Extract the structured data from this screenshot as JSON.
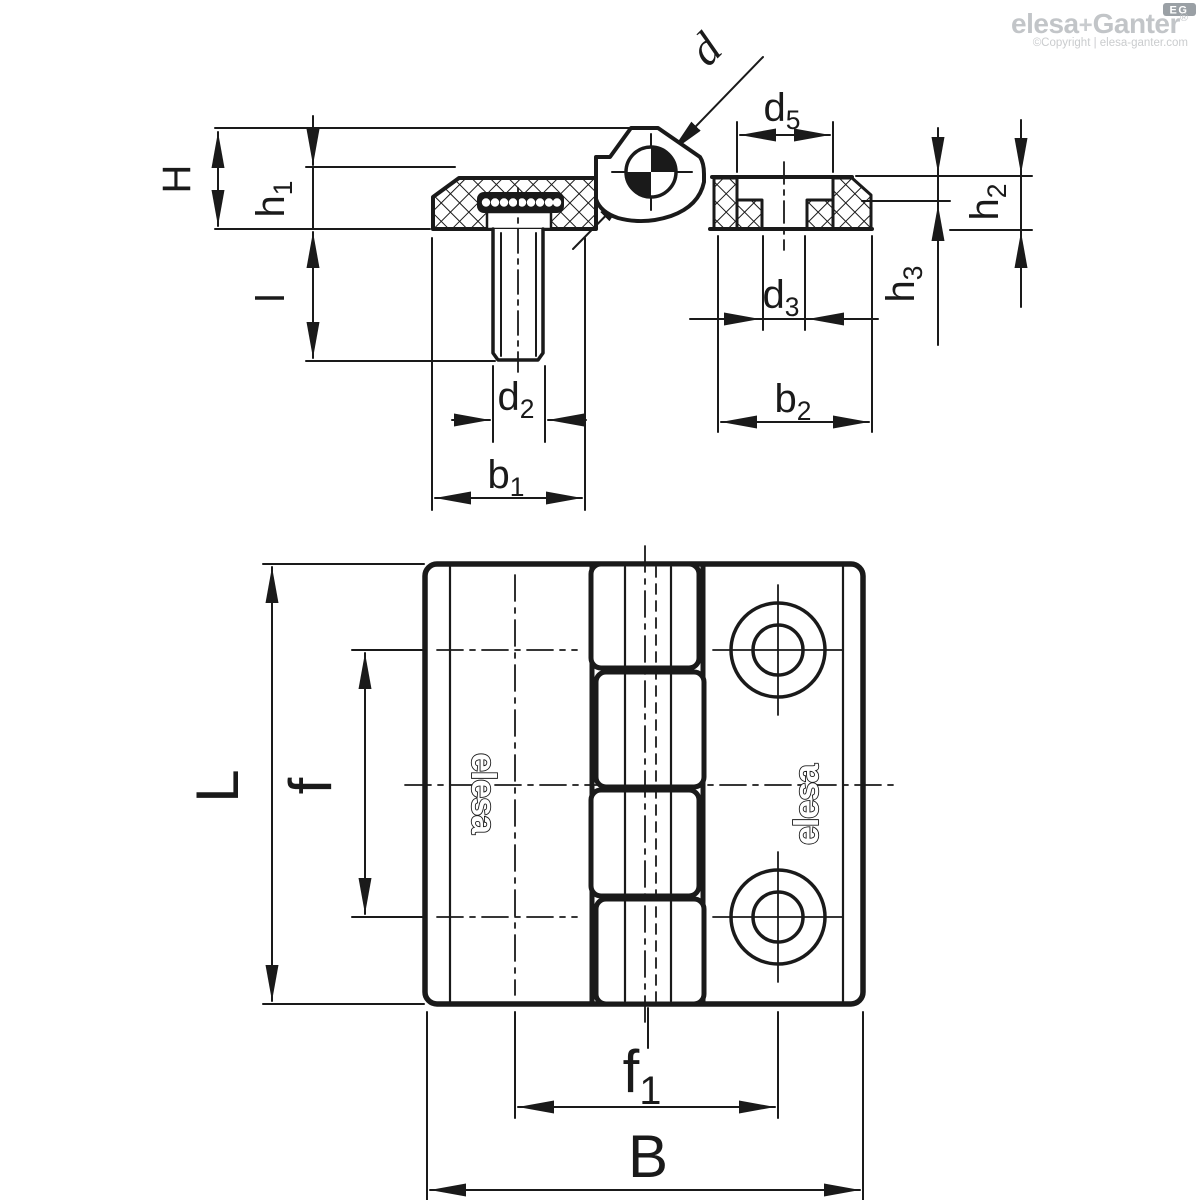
{
  "colors": {
    "line": "#1a1a1a",
    "watermark_gray": "#c2c5c8",
    "badge_gray": "#9aa0a5"
  },
  "watermark": {
    "brand_elesa": "elesa",
    "brand_plus": "+",
    "brand_ganter": "Ganter",
    "brand_reg": "®",
    "badge": "EG",
    "copyright": "©Copyright | elesa-ganter.com"
  },
  "part_logo": {
    "left": "elesa",
    "right": "elesa"
  },
  "dims": {
    "H": {
      "base": "H",
      "sub": ""
    },
    "h1": {
      "base": "h",
      "sub": "1"
    },
    "h2": {
      "base": "h",
      "sub": "2"
    },
    "h3": {
      "base": "h",
      "sub": "3"
    },
    "l": {
      "base": "l",
      "sub": ""
    },
    "d": {
      "base": "d",
      "sub": ""
    },
    "d2": {
      "base": "d",
      "sub": "2"
    },
    "d3": {
      "base": "d",
      "sub": "3"
    },
    "d5": {
      "base": "d",
      "sub": "5"
    },
    "b1": {
      "base": "b",
      "sub": "1"
    },
    "b2": {
      "base": "b",
      "sub": "2"
    },
    "L": {
      "base": "L",
      "sub": ""
    },
    "f": {
      "base": "f",
      "sub": ""
    },
    "f1": {
      "base": "f",
      "sub": "1"
    },
    "B": {
      "base": "B",
      "sub": ""
    }
  }
}
